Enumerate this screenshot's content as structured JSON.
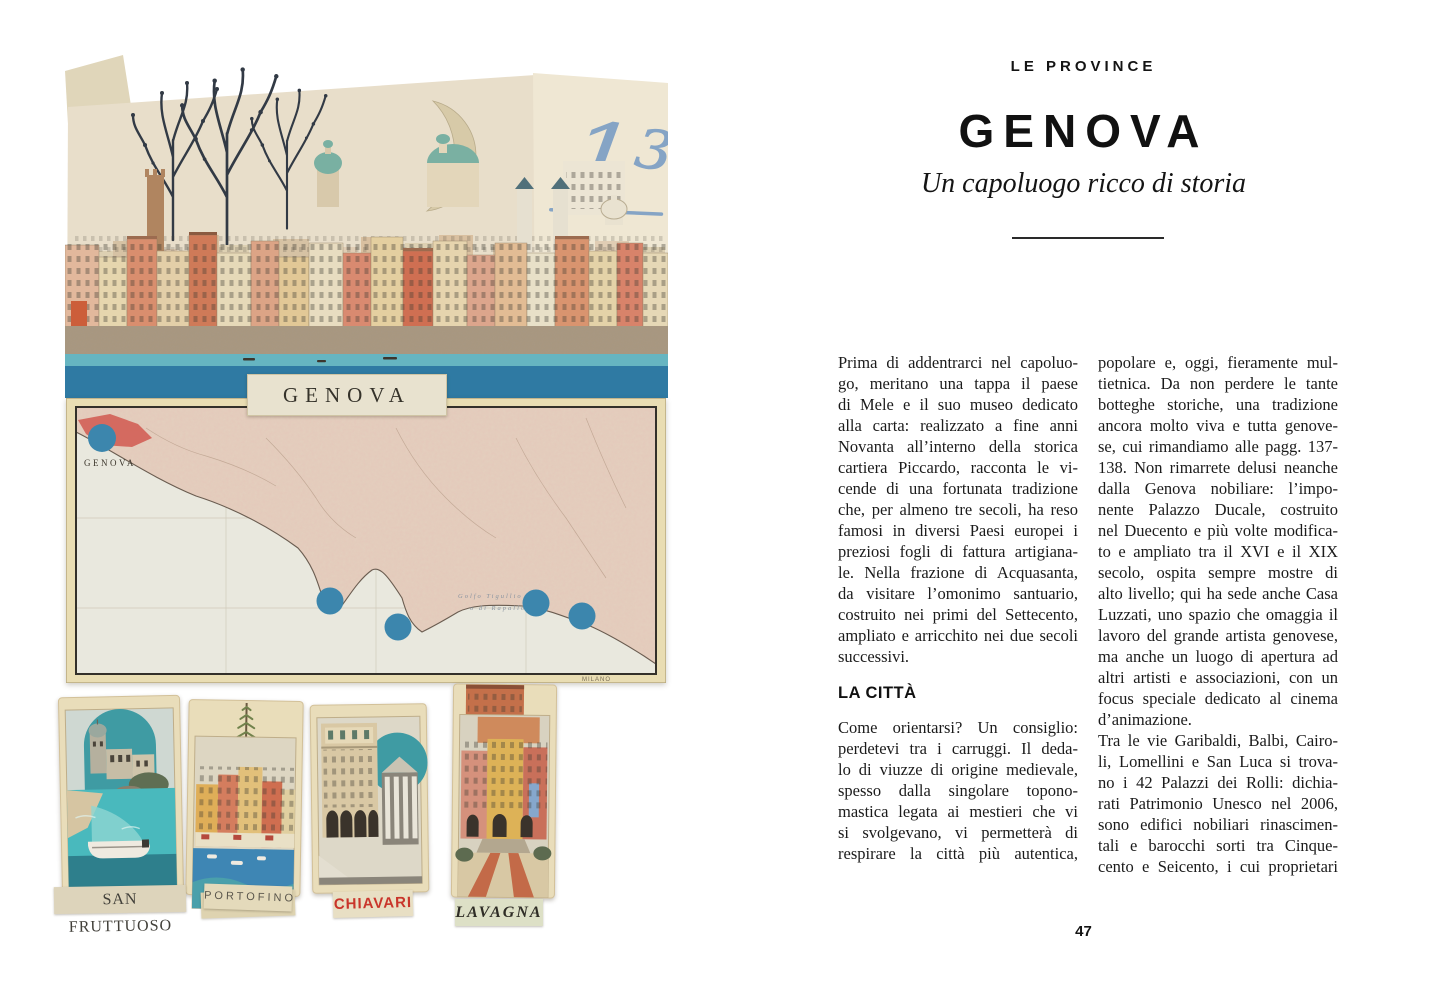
{
  "left_page": {
    "plaque_label": "GENOVA",
    "fraction": {
      "top": "1³",
      "bottom": "51"
    },
    "map": {
      "city_label": "GENOVA",
      "sea_label_line1": "Golfo Tigullio",
      "sea_label_line2": "o di Rapallo",
      "imprint": "MILANO"
    },
    "postcards": [
      {
        "label": "SAN FRUTTUOSO"
      },
      {
        "label": "PORTOFINO"
      },
      {
        "label": "CHIAVARI"
      },
      {
        "label": "LAVAGNA"
      }
    ]
  },
  "right_page": {
    "kicker": "LE PROVINCE",
    "title": "GENOVA",
    "subtitle": "Un capoluogo ricco di storia",
    "col1_para1_lines": [
      "Prima di addentrarci nel capoluo-",
      "go, meritano una tappa il paese",
      "di Mele e il suo museo dedicato",
      "alla carta: realizzato a fine anni",
      "Novanta all’interno della storica",
      "cartiera Piccardo, racconta le vi-",
      "cende di una fortunata tradizione",
      "che, per almeno tre secoli, ha reso",
      "famosi in diversi Paesi europei i",
      "preziosi fogli di fattura artigiana-",
      "le. Nella frazione di Acquasanta,",
      "da visitare l’omonimo santuario,",
      "costruito nei primi del Settecento,",
      "ampliato e arricchito nei due secoli",
      "successivi."
    ],
    "col1_heading": "LA CITTÀ",
    "col1_para2_lines": [
      "Come orientarsi? Un consiglio:",
      "perdetevi tra i carruggi. Il deda-",
      "lo di viuzze di origine medievale,",
      "spesso dalla singolare topono-",
      "mastica legata ai mestieri che vi",
      "si svolgevano, vi permetterà di",
      "respirare la città più autentica,"
    ],
    "col2_para1_lines": [
      "popolare e, oggi, fieramente mul-",
      "tietnica. Da non perdere le tante",
      "botteghe storiche, una tradizione",
      "ancora molto viva e tutta genove-",
      "se, cui rimandiamo alle pagg. 137-",
      "138. Non rimarrete delusi neanche",
      "dalla Genova nobiliare: l’impo-",
      "nente Palazzo Ducale, costruito",
      "nel Duecento e più volte modifica-",
      "to e ampliato tra il XVI e il XIX",
      "secolo, ospita sempre mostre di",
      "alto livello; qui ha sede anche Casa",
      "Luzzati, uno spazio che omaggia il",
      "lavoro del grande artista genovese,",
      "ma anche un luogo di apertura ad",
      "altri artisti e associazioni, con un",
      "focus speciale dedicato al cinema",
      "d’animazione."
    ],
    "col2_para2_lines": [
      "Tra le vie Garibaldi, Balbi, Cairo-",
      "li, Lomellini e San Luca si trova-",
      "no i 42 Palazzi dei Rolli: dichia-",
      "rati Patrimonio Unesco nel 2006,",
      "sono edifici nobiliari rinascimen-",
      "tali e barocchi sorti tra Cinque-",
      "cento e Seicento, i cui proprietari"
    ],
    "page_number": "47"
  },
  "colors": {
    "sea_dark_blue": "#2f7aa3",
    "sea_light_teal": "#66b5c1",
    "map_dot_blue": "#3c86ad",
    "arch_teal": "#3f9ba3",
    "chiavari_red": "#c9352b",
    "handwriting_blue": "#7d9fc4"
  }
}
